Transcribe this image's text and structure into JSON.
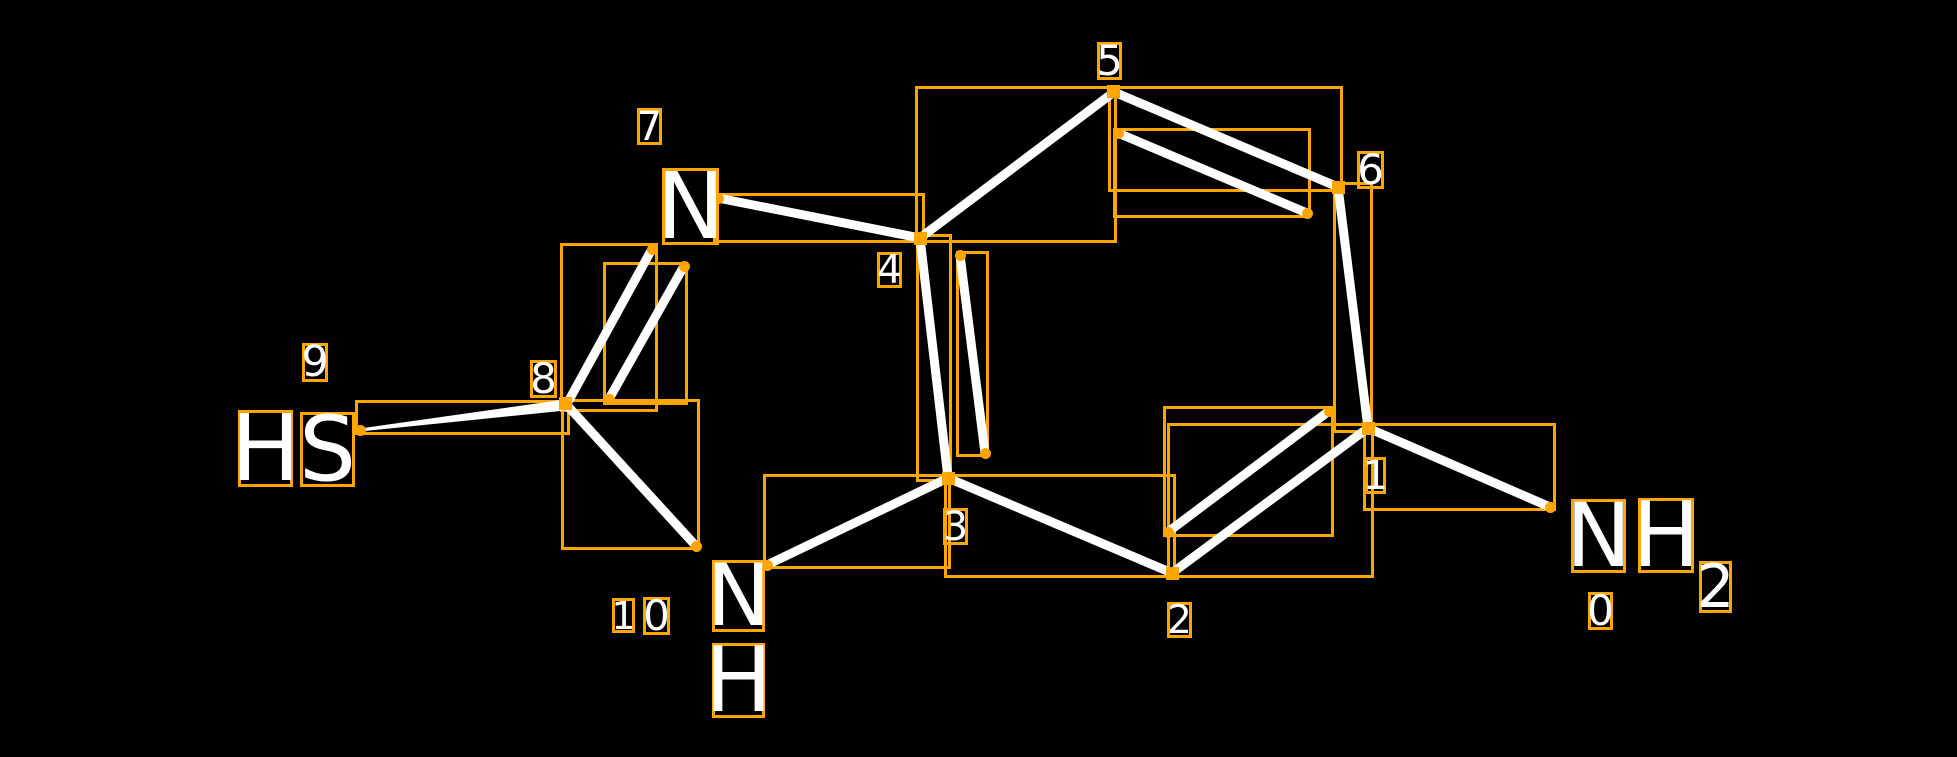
{
  "scene": {
    "width": 1957,
    "height": 757,
    "background": "#000000"
  },
  "colors": {
    "annotation_box": "#FFA500",
    "bond": "#FFFFFF",
    "label_text": "#FFFFFF"
  },
  "molecule": {
    "visible_atom_labels": [
      "HS",
      "N",
      "NH",
      "NH2"
    ],
    "visible_index_labels": [
      "0",
      "1",
      "2",
      "3",
      "4",
      "5",
      "6",
      "7",
      "8",
      "9",
      "10"
    ],
    "bonds_summary": [
      {
        "from": 9,
        "to": 8,
        "order": 1,
        "wedge": true
      },
      {
        "from": 8,
        "to": 7,
        "order": 2
      },
      {
        "from": 7,
        "to": 4,
        "order": 1
      },
      {
        "from": 4,
        "to": 5,
        "order": 1
      },
      {
        "from": 5,
        "to": 6,
        "order": 2
      },
      {
        "from": 6,
        "to": 1,
        "order": 1
      },
      {
        "from": 1,
        "to": 0,
        "order": 1
      },
      {
        "from": 1,
        "to": 2,
        "order": 2
      },
      {
        "from": 2,
        "to": 3,
        "order": 1
      },
      {
        "from": 3,
        "to": 4,
        "order": 2
      },
      {
        "from": 3,
        "to": 10,
        "order": 1
      },
      {
        "from": 10,
        "to": 8,
        "order": 1
      }
    ],
    "bond_lines": [
      {
        "name": "bond-9-8",
        "from": [
          360,
          430
        ],
        "to": [
          565,
          405
        ],
        "style": "wedge"
      },
      {
        "name": "bond-8-7-main",
        "from": [
          568,
          402
        ],
        "to": [
          652,
          249
        ]
      },
      {
        "name": "bond-8-7-inner",
        "from": [
          609,
          399
        ],
        "to": [
          684,
          266
        ]
      },
      {
        "name": "bond-7-4",
        "from": [
          718,
          198
        ],
        "to": [
          920,
          238
        ]
      },
      {
        "name": "bond-4-5",
        "from": [
          920,
          238
        ],
        "to": [
          1114,
          92
        ]
      },
      {
        "name": "bond-5-6-main",
        "from": [
          1114,
          92
        ],
        "to": [
          1338,
          187
        ]
      },
      {
        "name": "bond-5-6-inner",
        "from": [
          1118,
          133
        ],
        "to": [
          1307,
          213
        ]
      },
      {
        "name": "bond-6-1",
        "from": [
          1338,
          187
        ],
        "to": [
          1368,
          428
        ]
      },
      {
        "name": "bond-1-0",
        "from": [
          1368,
          428
        ],
        "to": [
          1550,
          507
        ]
      },
      {
        "name": "bond-1-2-main",
        "from": [
          1368,
          428
        ],
        "to": [
          1172,
          573
        ]
      },
      {
        "name": "bond-1-2-inner",
        "from": [
          1329,
          411
        ],
        "to": [
          1168,
          532
        ]
      },
      {
        "name": "bond-2-3",
        "from": [
          1172,
          573
        ],
        "to": [
          948,
          478
        ]
      },
      {
        "name": "bond-3-4-main",
        "from": [
          948,
          478
        ],
        "to": [
          920,
          238
        ]
      },
      {
        "name": "bond-3-4-inner",
        "from": [
          960,
          255
        ],
        "to": [
          985,
          453
        ]
      },
      {
        "name": "bond-3-10",
        "from": [
          948,
          478
        ],
        "to": [
          767,
          565
        ]
      },
      {
        "name": "bond-8-10",
        "from": [
          565,
          403
        ],
        "to": [
          696,
          546
        ]
      }
    ]
  },
  "annotations": {
    "bond_boxes": [
      {
        "name": "box-bond-9-8",
        "rect": [
          355,
          400,
          215,
          35
        ]
      },
      {
        "name": "box-bond-8-7-main",
        "rect": [
          560,
          243,
          98,
          169
        ]
      },
      {
        "name": "box-bond-8-7-inner",
        "rect": [
          603,
          262,
          85,
          143
        ]
      },
      {
        "name": "box-bond-7-4",
        "rect": [
          713,
          193,
          212,
          50
        ]
      },
      {
        "name": "box-bond-4-5",
        "rect": [
          915,
          86,
          202,
          157
        ]
      },
      {
        "name": "box-bond-5-6-main",
        "rect": [
          1108,
          86,
          235,
          106
        ]
      },
      {
        "name": "box-bond-5-6-inner",
        "rect": [
          1113,
          128,
          198,
          90
        ]
      },
      {
        "name": "box-bond-6-1",
        "rect": [
          1333,
          182,
          40,
          251
        ]
      },
      {
        "name": "box-bond-1-0",
        "rect": [
          1363,
          423,
          193,
          88
        ]
      },
      {
        "name": "box-bond-1-2-main",
        "rect": [
          1167,
          423,
          207,
          155
        ]
      },
      {
        "name": "box-bond-1-2-inner",
        "rect": [
          1163,
          406,
          171,
          131
        ]
      },
      {
        "name": "box-bond-2-3",
        "rect": [
          944,
          474,
          232,
          104
        ]
      },
      {
        "name": "box-bond-3-4-main",
        "rect": [
          916,
          234,
          36,
          248
        ]
      },
      {
        "name": "box-bond-3-4-inner",
        "rect": [
          956,
          251,
          33,
          206
        ]
      },
      {
        "name": "box-bond-3-10",
        "rect": [
          763,
          474,
          188,
          95
        ]
      },
      {
        "name": "box-bond-8-10",
        "rect": [
          561,
          399,
          139,
          151
        ]
      }
    ],
    "vertex_boxes": [
      {
        "name": "vertex-box-5",
        "rect": [
          1107,
          85,
          13,
          13
        ]
      },
      {
        "name": "vertex-box-6",
        "rect": [
          1332,
          181,
          13,
          13
        ]
      },
      {
        "name": "vertex-box-4",
        "rect": [
          914,
          232,
          13,
          13
        ]
      },
      {
        "name": "vertex-box-8",
        "rect": [
          559,
          397,
          13,
          13
        ]
      },
      {
        "name": "vertex-box-3",
        "rect": [
          942,
          472,
          13,
          13
        ]
      },
      {
        "name": "vertex-box-2",
        "rect": [
          1166,
          567,
          13,
          13
        ]
      },
      {
        "name": "vertex-box-1",
        "rect": [
          1362,
          422,
          13,
          13
        ]
      }
    ],
    "endpoint_dots": [
      [
        360,
        430
      ],
      [
        565,
        404
      ],
      [
        609,
        399
      ],
      [
        652,
        249
      ],
      [
        684,
        266
      ],
      [
        718,
        198
      ],
      [
        696,
        546
      ],
      [
        767,
        565
      ],
      [
        920,
        238
      ],
      [
        948,
        478
      ],
      [
        960,
        255
      ],
      [
        985,
        453
      ],
      [
        1114,
        92
      ],
      [
        1118,
        133
      ],
      [
        1172,
        573
      ],
      [
        1168,
        532
      ],
      [
        1307,
        213
      ],
      [
        1329,
        411
      ],
      [
        1338,
        187
      ],
      [
        1368,
        428
      ],
      [
        1550,
        507
      ]
    ],
    "atom_glyphs": [
      {
        "name": "atom-9-glyph-H",
        "text": "H",
        "rect": [
          238,
          410,
          55,
          77
        ]
      },
      {
        "name": "atom-9-glyph-S",
        "text": "S",
        "rect": [
          300,
          412,
          55,
          75
        ]
      },
      {
        "name": "atom-7-glyph-N",
        "text": "N",
        "rect": [
          662,
          168,
          57,
          77
        ]
      },
      {
        "name": "atom-10-glyph-N",
        "text": "N",
        "rect": [
          712,
          560,
          53,
          72
        ]
      },
      {
        "name": "atom-10-glyph-H",
        "text": "H",
        "rect": [
          712,
          643,
          53,
          75
        ]
      },
      {
        "name": "atom-0-glyph-N",
        "text": "N",
        "rect": [
          1571,
          499,
          55,
          74
        ]
      },
      {
        "name": "atom-0-glyph-H",
        "text": "H",
        "rect": [
          1638,
          498,
          56,
          75
        ]
      },
      {
        "name": "atom-0-glyph-sub2",
        "text": "2",
        "rect": [
          1699,
          561,
          33,
          52
        ]
      }
    ],
    "index_labels": [
      {
        "name": "index-label-9",
        "text": "9",
        "rect": [
          302,
          343,
          26,
          39
        ]
      },
      {
        "name": "index-label-8",
        "text": "8",
        "rect": [
          530,
          360,
          27,
          38
        ]
      },
      {
        "name": "index-label-7",
        "text": "7",
        "rect": [
          637,
          108,
          25,
          37
        ]
      },
      {
        "name": "index-label-10-tens",
        "text": "1",
        "rect": [
          612,
          598,
          23,
          35
        ]
      },
      {
        "name": "index-label-10-ones",
        "text": "0",
        "rect": [
          643,
          597,
          27,
          38
        ]
      },
      {
        "name": "index-label-4",
        "text": "4",
        "rect": [
          877,
          252,
          25,
          36
        ]
      },
      {
        "name": "index-label-5",
        "text": "5",
        "rect": [
          1097,
          42,
          25,
          38
        ]
      },
      {
        "name": "index-label-3",
        "text": "3",
        "rect": [
          943,
          508,
          25,
          37
        ]
      },
      {
        "name": "index-label-2",
        "text": "2",
        "rect": [
          1167,
          602,
          25,
          36
        ]
      },
      {
        "name": "index-label-6",
        "text": "6",
        "rect": [
          1357,
          151,
          27,
          38
        ]
      },
      {
        "name": "index-label-1",
        "text": "1",
        "rect": [
          1365,
          457,
          21,
          37
        ]
      },
      {
        "name": "index-label-0",
        "text": "0",
        "rect": [
          1588,
          592,
          25,
          38
        ]
      }
    ]
  }
}
